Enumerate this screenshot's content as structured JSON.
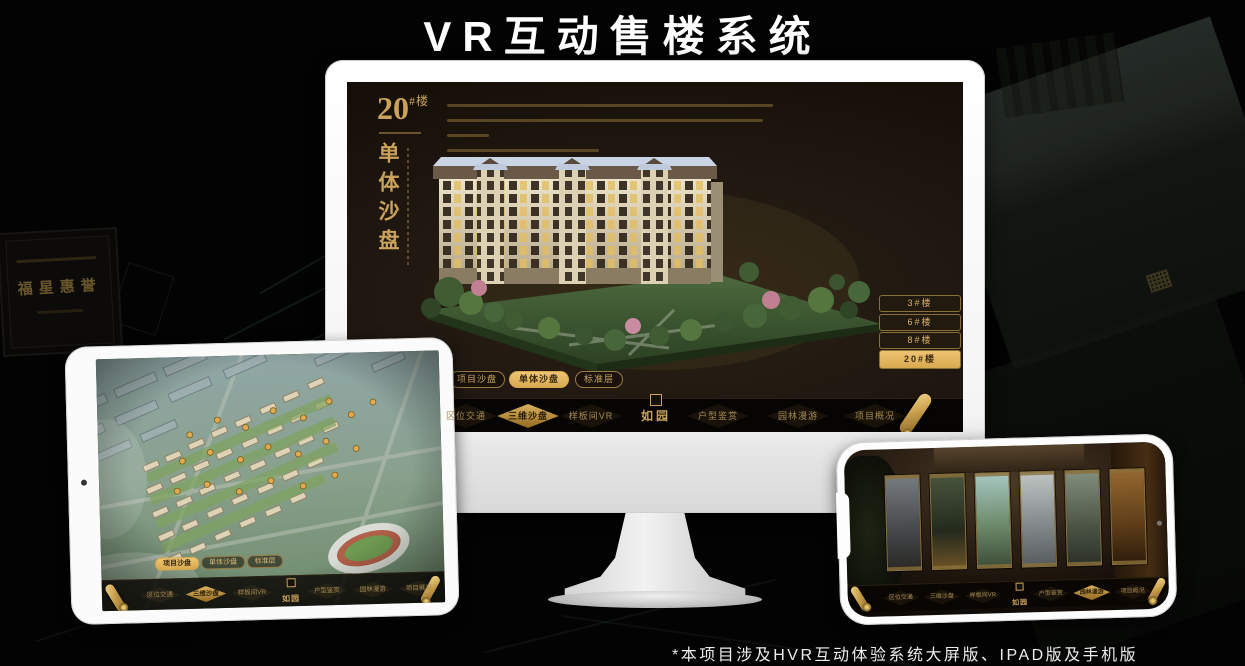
{
  "page": {
    "title": "VR互动售楼系统",
    "footnote": "*本项目涉及HVR互动体验系统大屏版、IPAD版及手机版"
  },
  "colors": {
    "gold": "#caa25a",
    "gold_active": "#e3b461",
    "screen_bg": "#1a130b",
    "device_shell": "#f5f5f5"
  },
  "background": {
    "plaque_title": "福星惠誉"
  },
  "monitor_app": {
    "headline_number": "20",
    "headline_suffix": "#楼",
    "headline_vertical": "单体沙盘",
    "tabs": [
      {
        "label": "项目沙盘"
      },
      {
        "label": "单体沙盘"
      },
      {
        "label": "标准层"
      }
    ],
    "active_tab": "单体沙盘",
    "floor_buttons": [
      {
        "label": "3#楼"
      },
      {
        "label": "6#楼"
      },
      {
        "label": "8#楼"
      },
      {
        "label": "20#楼"
      }
    ],
    "active_floor": "20#楼",
    "nav": {
      "logo": "如园",
      "items": [
        {
          "label": "区位交通"
        },
        {
          "label": "三维沙盘"
        },
        {
          "label": "样板间VR"
        },
        {
          "label": "户型鉴赏"
        },
        {
          "label": "园林漫游"
        },
        {
          "label": "项目概况"
        }
      ],
      "active_item": "三维沙盘"
    }
  },
  "tablet_app": {
    "tabs": [
      {
        "label": "项目沙盘"
      },
      {
        "label": "单体沙盘"
      },
      {
        "label": "标准层"
      }
    ],
    "active_tab": "项目沙盘",
    "nav": {
      "logo": "如园",
      "items": [
        {
          "label": "区位交通"
        },
        {
          "label": "三维沙盘"
        },
        {
          "label": "样板间VR"
        },
        {
          "label": "户型鉴赏"
        },
        {
          "label": "园林漫游"
        },
        {
          "label": "项目概况"
        }
      ],
      "active_item": "三维沙盘"
    }
  },
  "phone_app": {
    "nav": {
      "logo": "如园",
      "items": [
        {
          "label": "区位交通"
        },
        {
          "label": "三维沙盘"
        },
        {
          "label": "样板间VR"
        },
        {
          "label": "户型鉴赏"
        },
        {
          "label": "园林漫游"
        },
        {
          "label": "项目概况"
        }
      ],
      "active_item": "园林漫游"
    }
  }
}
